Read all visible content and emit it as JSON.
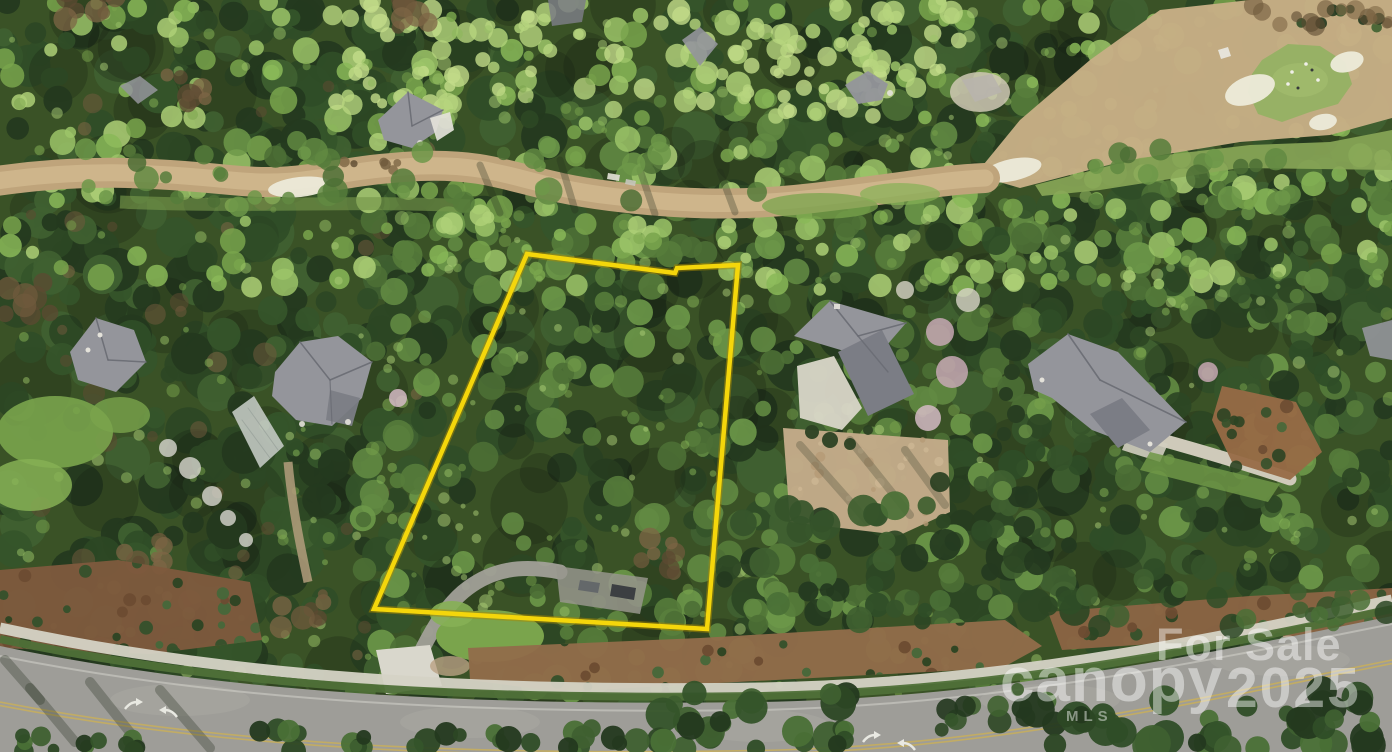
{
  "description": "Aerial drone photograph of a wooded residential homesite for sale, outlined in yellow, along a curving street in a golf-course community",
  "canvas": {
    "width": 1392,
    "height": 752
  },
  "watermark": {
    "for_sale": "For Sale",
    "brand": "canopy",
    "brand_sub": "MLS",
    "year": "2025",
    "color": "#ffffff",
    "opacity": 0.45
  },
  "boundary": {
    "color": "#f4d60b",
    "outline_color": "#a98a00",
    "stroke_width": 4.5,
    "points": [
      [
        527,
        254
      ],
      [
        675,
        273
      ],
      [
        677,
        268
      ],
      [
        738,
        265
      ],
      [
        707,
        629
      ],
      [
        374,
        609
      ]
    ],
    "closed": true
  },
  "road_markings": {
    "center_line_color": "#cbb057",
    "arrow_color": "#e9e9e2",
    "turn_arrow_pairs": [
      [
        150,
        709
      ],
      [
        888,
        742
      ]
    ]
  },
  "palette": {
    "forest_base": "#3a5226",
    "forest_dark": [
      "#24391f",
      "#2c4724",
      "#35542a",
      "#2f4d27",
      "#3f6030"
    ],
    "forest_mid": [
      "#4c6f35",
      "#567c3b",
      "#628a42",
      "#6d9849"
    ],
    "forest_bright": [
      "#79a44c",
      "#8ab858",
      "#9cc468",
      "#aed077"
    ],
    "forest_pale": [
      "#b7d47e",
      "#c3dc8a"
    ],
    "shadow_blob": "rgba(18,28,14,0.25)",
    "brown_tree": [
      "#6f5a3c",
      "#7d6645",
      "#5c4a31"
    ],
    "pink_tree": [
      "#c7a8b4",
      "#d3bac4"
    ],
    "white_tree": "#d8d5c7",
    "dirt_road": "#bfa47b",
    "dirt_road_core": "#d0b88e",
    "golf_tan": "#c6ae85",
    "golf_grass": "#8aa758",
    "putting_green": "#96b164",
    "putting_green_hi": "#a2bc6e",
    "sand": "#ecead9",
    "roof": "#94959b",
    "roof_dark": "#7b7d85",
    "roof_line": "#6a6c74",
    "wall_white": "#e4e2da",
    "greenhouse": "#c6ccc6",
    "lawn": "#7aa44c",
    "lawn_hi": "#86b055",
    "gravel": "#c3ab89",
    "concrete": "#d9d6c8",
    "drive_gray": "#a5a39b",
    "pavement": "#98968d",
    "mulch": [
      "#7e5a3d",
      "#916c4a",
      "#8a6444"
    ],
    "bush": [
      "#35512b",
      "#2c4423",
      "#6d4c32",
      "#46683a"
    ],
    "road": "#9e9d98",
    "road_hi": "#adaca4",
    "sidewalk": "#d5d3c5",
    "verge": "#4f7038",
    "edge_line": "#d8d7cf",
    "car_dark": "#3c3f42",
    "car_gray": "#606468",
    "shadow_streak": "rgba(35,45,30,0.3)"
  }
}
